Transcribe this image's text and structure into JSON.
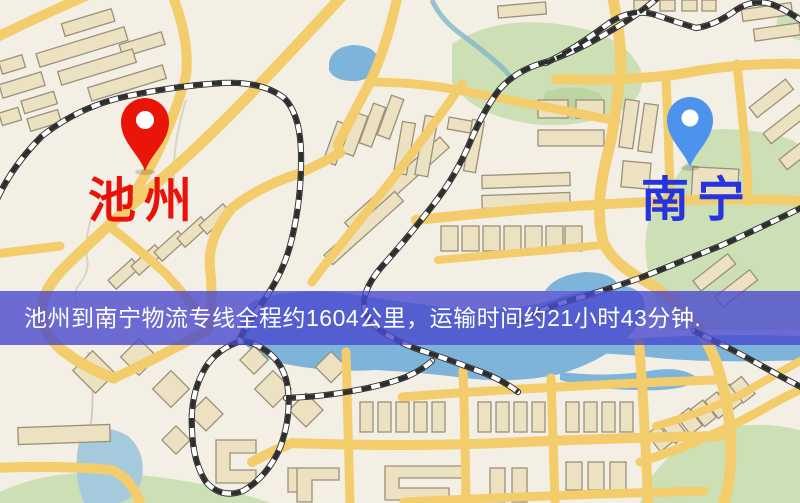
{
  "route_map": {
    "origin": {
      "label": "池州",
      "pin_color": "#ee1407",
      "label_color": "#e8120a"
    },
    "destination": {
      "label": "南宁",
      "pin_color": "#4a93f0",
      "label_color": "#2634de"
    },
    "banner": {
      "text": "池州到南宁物流专线全程约1604公里，运输时间约21小时43分钟.",
      "background_color": "#4a4ace",
      "text_color": "#ffffff",
      "distance_km": "1604",
      "transit_time": "21小时43分钟"
    },
    "palette": {
      "map_background": "#f3efe4",
      "road": "#f4cd68",
      "water": "#7db4da",
      "green_area": "#ccdfb4",
      "building_fill": "#ece1c0",
      "building_outline": "#9b9078",
      "railway": "#2e2e2e"
    }
  }
}
